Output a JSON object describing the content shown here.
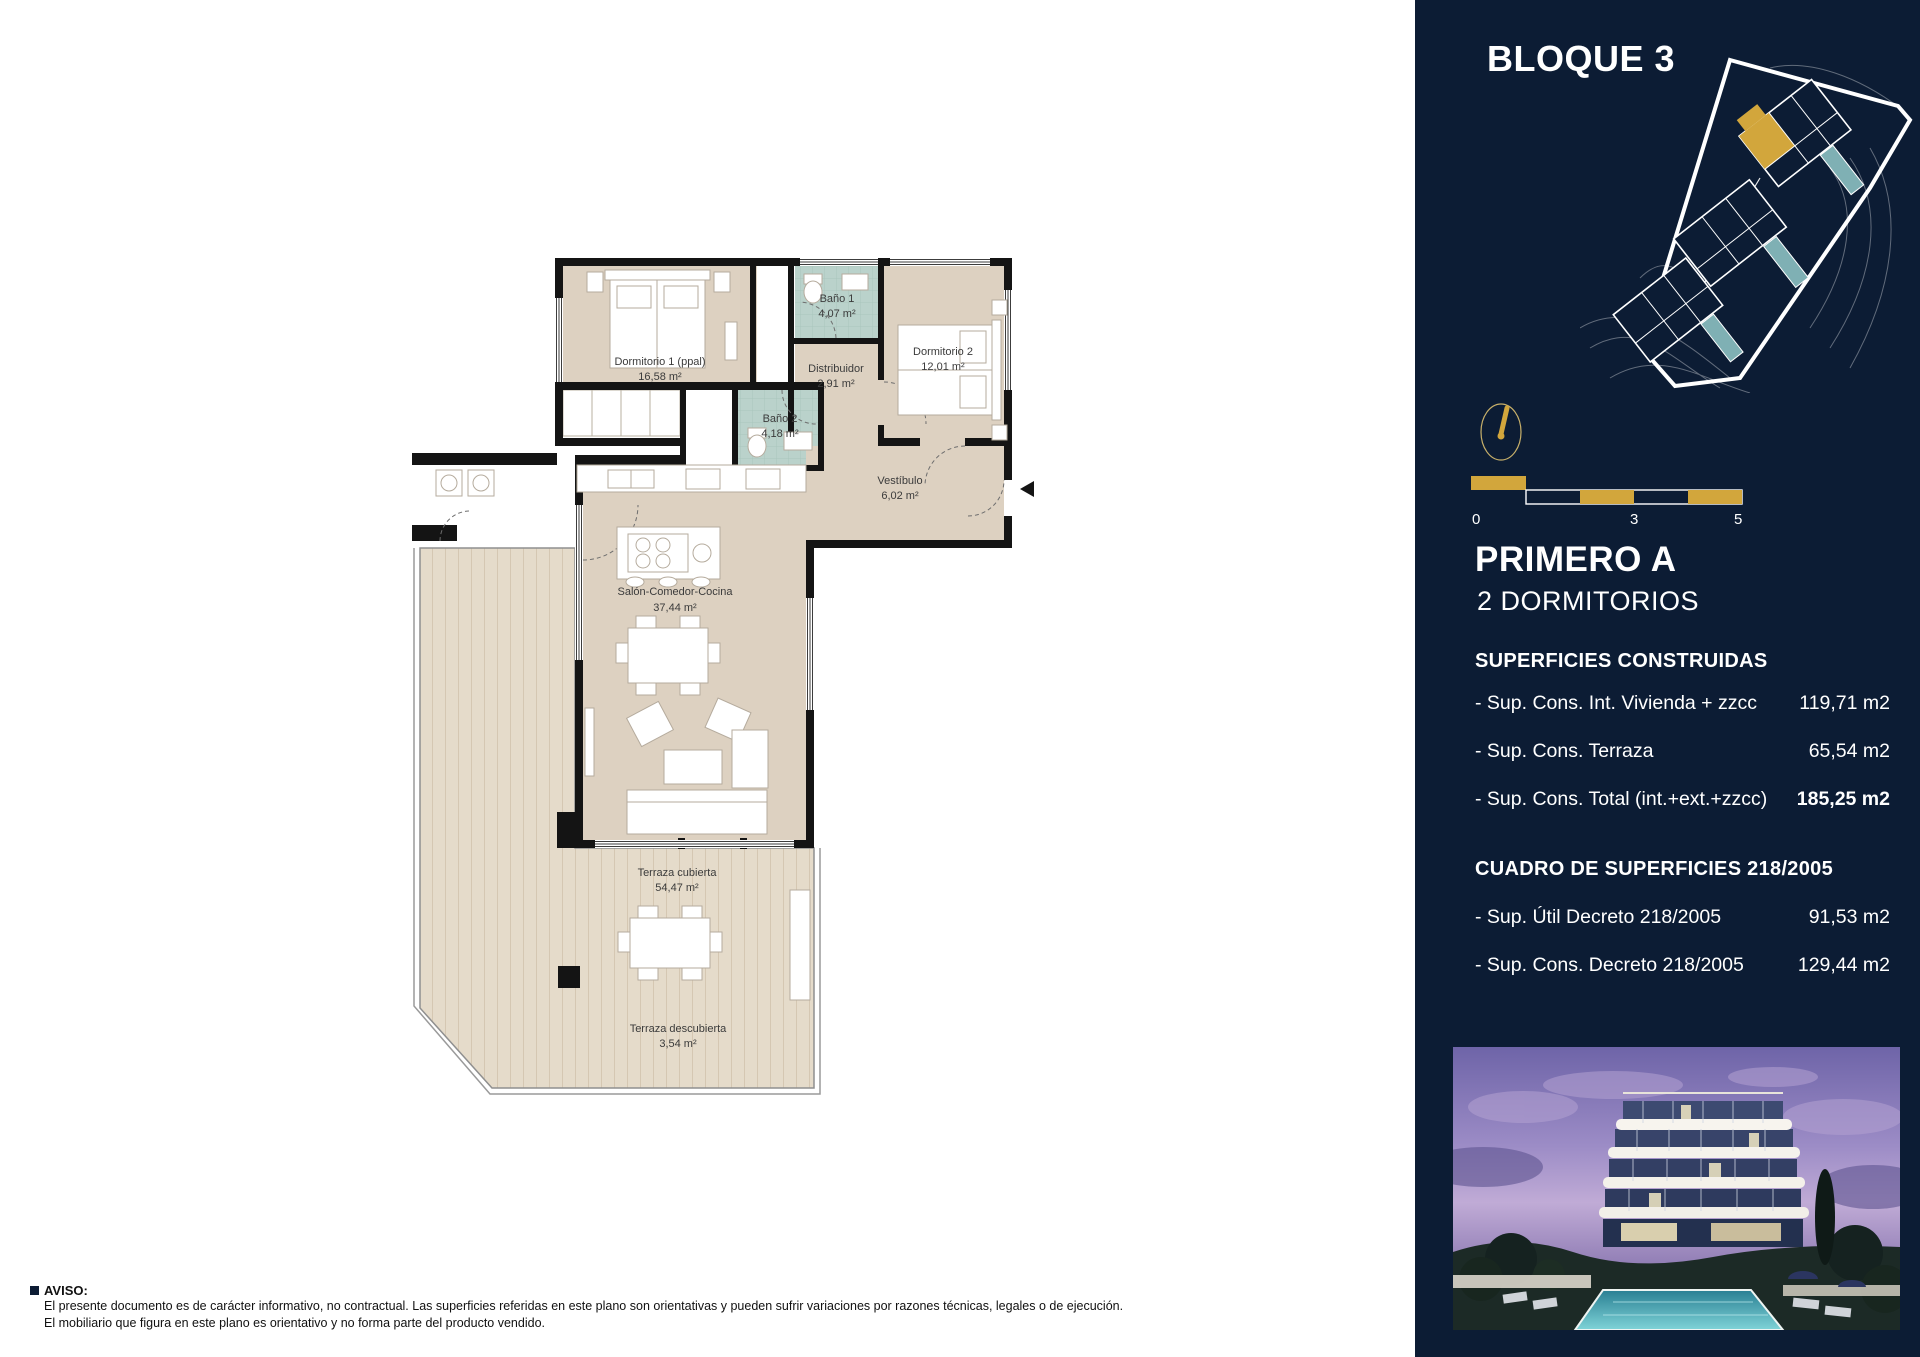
{
  "sidebar": {
    "bg_color": "#0c1c34",
    "accent_color": "#d2a63c",
    "block_title": "BLOQUE 3",
    "unit_title": "PRIMERO A",
    "unit_subtitle": "2 DORMITORIOS",
    "scale_bar": {
      "start": "0",
      "mid": "3",
      "end": "5"
    },
    "compass_icon": "north-needle",
    "sections": [
      {
        "title": "SUPERFICIES CONSTRUIDAS",
        "rows": [
          {
            "label": "- Sup. Cons. Int. Vivienda + zzcc",
            "value": "119,71 m2"
          },
          {
            "label": "- Sup. Cons. Terraza",
            "value": "65,54 m2"
          },
          {
            "label": "- Sup. Cons. Total (int.+ext.+zzcc)",
            "value": "185,25 m2"
          }
        ]
      },
      {
        "title": "CUADRO DE SUPERFICIES 218/2005",
        "rows": [
          {
            "label": "- Sup. Útil Decreto 218/2005",
            "value": "91,53 m2"
          },
          {
            "label": "- Sup. Cons. Decreto 218/2005",
            "value": "129,44 m2"
          }
        ]
      }
    ]
  },
  "floor_plan": {
    "wall_color": "#141414",
    "room_fill": "#ddd1c1",
    "terrace_fill": "#e5dbca",
    "bath_fill": "#bad2cb",
    "rooms": [
      {
        "name": "Dormitorio 1 (ppal)",
        "area": "16,58 m²"
      },
      {
        "name": "Baño 1",
        "area": "4,07 m²"
      },
      {
        "name": "Distribuidor",
        "area": "2,91 m²"
      },
      {
        "name": "Dormitorio 2",
        "area": "12,01 m²"
      },
      {
        "name": "Baño 2",
        "area": "4,18 m²"
      },
      {
        "name": "Vestíbulo",
        "area": "6,02 m²"
      },
      {
        "name": "Salón-Comedor-Cocina",
        "area": "37,44 m²"
      },
      {
        "name": "Terraza cubierta",
        "area": "54,47 m²"
      },
      {
        "name": "Terraza descubierta",
        "area": "3,54 m²"
      }
    ]
  },
  "footer": {
    "title": "AVISO:",
    "lines": [
      "El presente documento es de carácter informativo, no contractual. Las superficies referidas en este plano son orientativas y pueden sufrir variaciones por razones técnicas, legales o de ejecución.",
      "El mobiliario que figura en este plano es orientativo y no forma parte del producto vendido."
    ]
  }
}
